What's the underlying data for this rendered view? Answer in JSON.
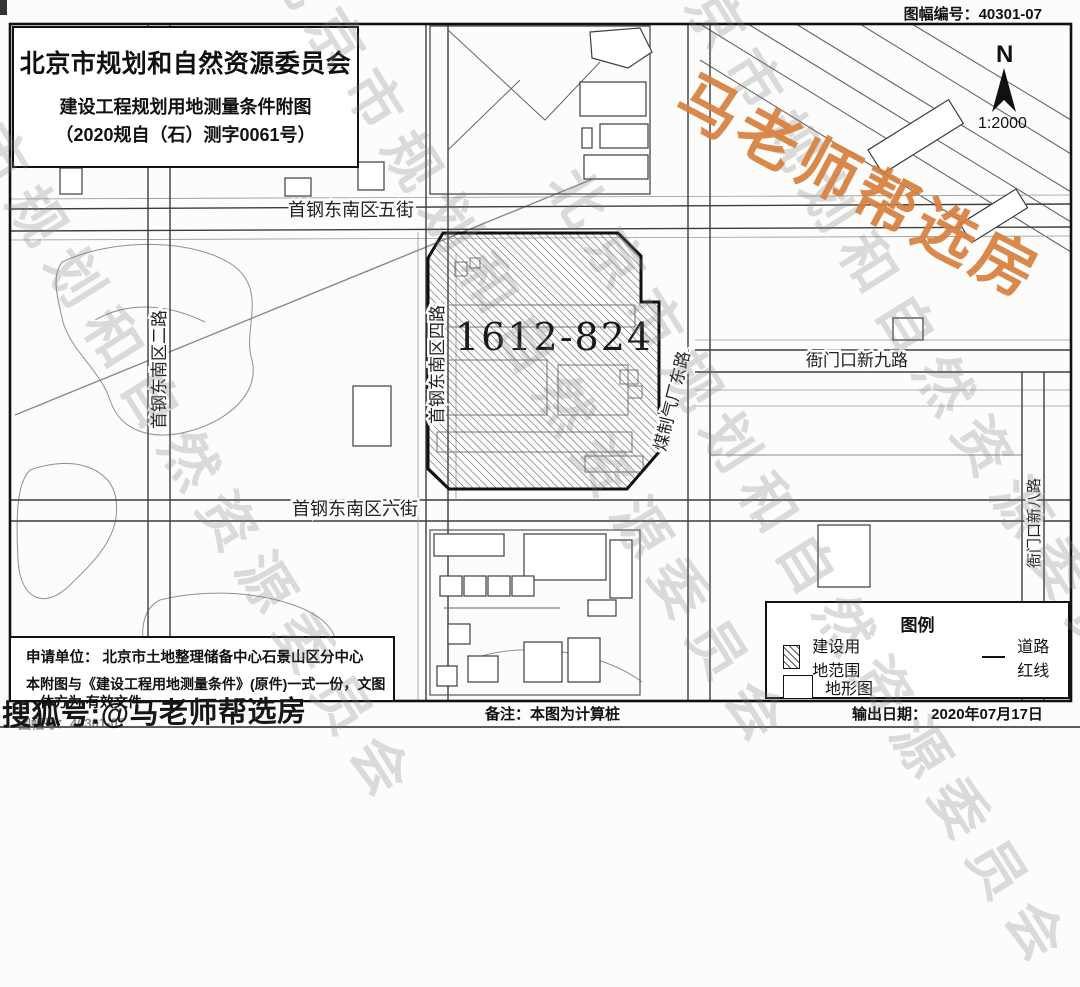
{
  "meta": {
    "sheet_number": "图幅编号：40301-07"
  },
  "title_block": {
    "agency": "北京市规划和自然资源委员会",
    "doc_title": "建设工程规划用地测量条件附图",
    "doc_number": "（2020规自（石）测字0061号）"
  },
  "compass": {
    "north": "N",
    "scale": "1:2000"
  },
  "parcel": {
    "label": "1612-824"
  },
  "roads": {
    "shougang_wujie": "首钢东南区五街",
    "shougang_erlu": "首钢东南区二路",
    "shougang_silu": "首钢东南区四路",
    "shougang_liujie": "首钢东南区六街",
    "meizhiqi_donglu": "煤制气厂东路",
    "yamenkou_xinjiulu": "衙门口新九路",
    "yamenkou_xinbalu": "衙门口新八路"
  },
  "legend": {
    "title": "图例",
    "item_parcel": "建设用地范围",
    "item_road": "道路红线",
    "item_topo": "地形图"
  },
  "info_block": {
    "applicant": "申请单位：  北京市土地整理储备中心石景山区分中心",
    "validity": "本附图与《建设工程用地测量条件》(原件)一式一份，文图一体方为 有效文件"
  },
  "footer": {
    "remark": "备注：本图为计算桩",
    "output_date": "输出日期： 2020年07月17日"
  },
  "watermarks": {
    "red_text": "马老师帮选房",
    "red_color": "#d8803e",
    "sohu_text": "搜狐号:@马老师帮选房",
    "gray_text": "北京市规划和自然资源委员会",
    "bottom_partial": "图幅号：40301-07"
  }
}
